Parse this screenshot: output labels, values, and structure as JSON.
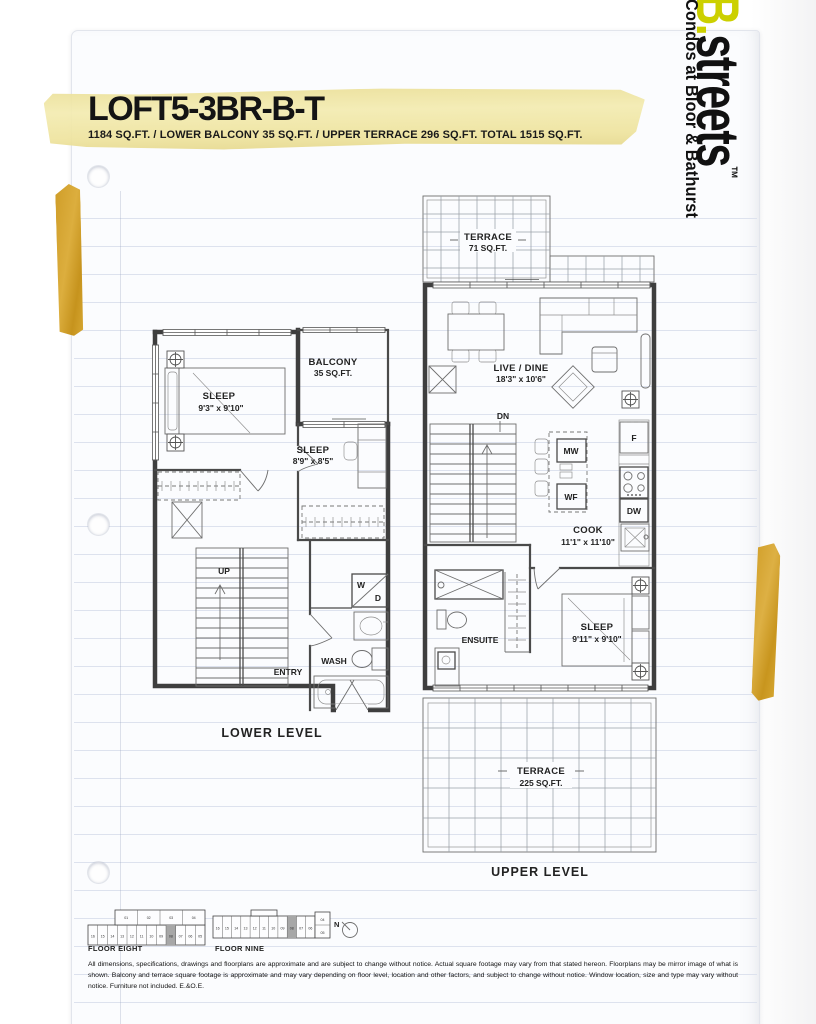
{
  "logo": {
    "brand_b": "B.",
    "brand_rest": "streets",
    "tm": "™",
    "tagline": "Condos at Bloor & Bathurst",
    "brand_yellow": "#ccd000"
  },
  "header": {
    "title": "LOFT5-3BR-B-T",
    "subtitle": "1184 SQ.FT.  /  LOWER BALCONY 35 SQ.FT.  /  UPPER TERRACE 296 SQ.FT. TOTAL 1515 SQ.FT."
  },
  "plans": {
    "lower": {
      "caption": "LOWER LEVEL",
      "sleep1_name": "SLEEP",
      "sleep1_dims": "9'3\" x 9'10\"",
      "sleep2_name": "SLEEP",
      "sleep2_dims": "8'9\" x 8'5\"",
      "balcony_name": "BALCONY",
      "balcony_dims": "35 SQ.FT.",
      "up": "UP",
      "entry": "ENTRY",
      "wash": "WASH",
      "w": "W",
      "d": "D"
    },
    "upper": {
      "caption": "UPPER LEVEL",
      "terrace_top_name": "TERRACE",
      "terrace_top_dims": "71 SQ.FT.",
      "live_name": "LIVE / DINE",
      "live_dims": "18'3\" x 10'6\"",
      "dn": "DN",
      "mw": "MW",
      "wf": "WF",
      "f": "F",
      "dw": "DW",
      "cook_name": "COOK",
      "cook_dims": "11'1\" x 11'10\"",
      "ensuite": "ENSUITE",
      "sleep_name": "SLEEP",
      "sleep_dims": "9'11\" x 9'10\"",
      "terrace_bottom_name": "TERRACE",
      "terrace_bottom_dims": "225 SQ.FT."
    }
  },
  "keyplans": {
    "floor_eight": {
      "label": "FLOOR EIGHT",
      "units_top": [
        "01",
        "02",
        "03",
        "04"
      ],
      "units": [
        "16",
        "15",
        "14",
        "13",
        "12",
        "11",
        "10",
        "09",
        "08",
        "07",
        "06",
        "05"
      ]
    },
    "floor_nine": {
      "label": "FLOOR NINE",
      "units": [
        "16",
        "15",
        "14",
        "13",
        "12",
        "11",
        "10",
        "09",
        "08",
        "07",
        "06"
      ],
      "stack": [
        "04",
        "05"
      ]
    },
    "north": "N"
  },
  "footer": {
    "disclaimer": "All dimensions, specifications, drawings and floorplans are approximate and are subject to change without notice. Actual square footage may vary from that stated hereon. Floorplans may be mirror image of what is shown. Balcony and terrace square footage is approximate and may vary depending on floor level, location and other factors, and subject to change without notice. Window location, size and type may vary without notice. Furniture not included. E.&O.E."
  }
}
